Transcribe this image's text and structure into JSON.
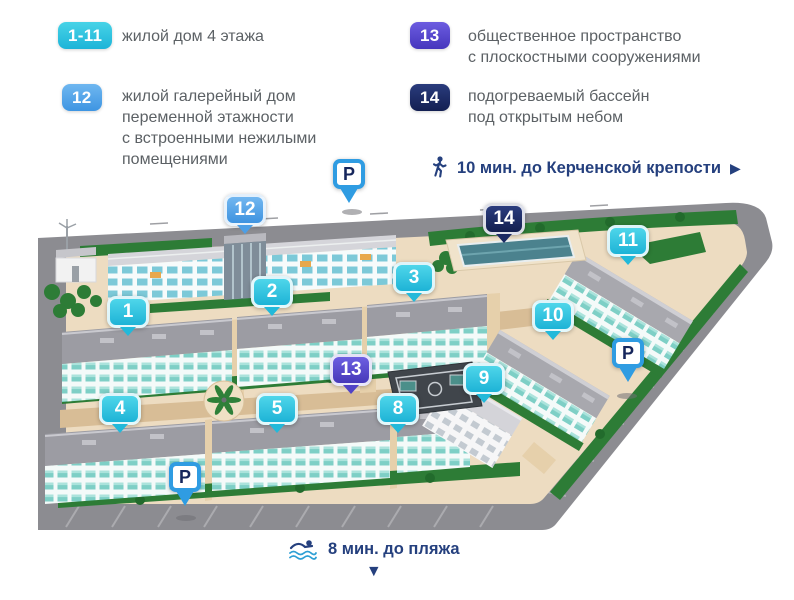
{
  "legend": {
    "items": [
      {
        "badge": "1-11",
        "color": "#2cc3e1",
        "text": "жилой дом 4 этажа"
      },
      {
        "badge": "12",
        "color": "#57a8e9",
        "text": "жилой галерейный дом\nпеременной этажности\nс встроенными нежилыми\nпомещениями"
      },
      {
        "badge": "13",
        "color": "#5948ce",
        "text": "общественное пространство\nс плоскостными сооружениями"
      },
      {
        "badge": "14",
        "color": "#1c2b66",
        "text": "подогреваемый бассейн\nпод открытым небом"
      }
    ]
  },
  "annotations": {
    "walk": {
      "icon": "walking-person-icon",
      "text": "10 мин. до Керченской крепости",
      "arrow": "▶"
    },
    "swim": {
      "icon": "swimmer-icon",
      "text": "8 мин. до пляжа",
      "arrow": "▼"
    }
  },
  "map": {
    "markers": [
      {
        "label": "1",
        "variant": "cyan"
      },
      {
        "label": "2",
        "variant": "cyan"
      },
      {
        "label": "3",
        "variant": "cyan"
      },
      {
        "label": "4",
        "variant": "cyan"
      },
      {
        "label": "5",
        "variant": "cyan"
      },
      {
        "label": "8",
        "variant": "cyan"
      },
      {
        "label": "9",
        "variant": "cyan"
      },
      {
        "label": "10",
        "variant": "cyan"
      },
      {
        "label": "11",
        "variant": "cyan"
      },
      {
        "label": "12",
        "variant": "blue"
      },
      {
        "label": "13",
        "variant": "purple"
      },
      {
        "label": "14",
        "variant": "navy"
      },
      {
        "label": "P",
        "variant": "parking"
      },
      {
        "label": "P",
        "variant": "parking"
      },
      {
        "label": "P",
        "variant": "parking"
      }
    ]
  },
  "colors": {
    "marker_cyan": "#2cc3e1",
    "marker_blue": "#57a8e9",
    "marker_purple": "#5948ce",
    "marker_navy": "#1c2b66",
    "parking_border": "#2f9ce2",
    "legend_text": "#5c6165",
    "annotation_text": "#25407e",
    "road": "#8c8c91",
    "ground": "#eddcc1",
    "greenery": "#2d7c36"
  }
}
